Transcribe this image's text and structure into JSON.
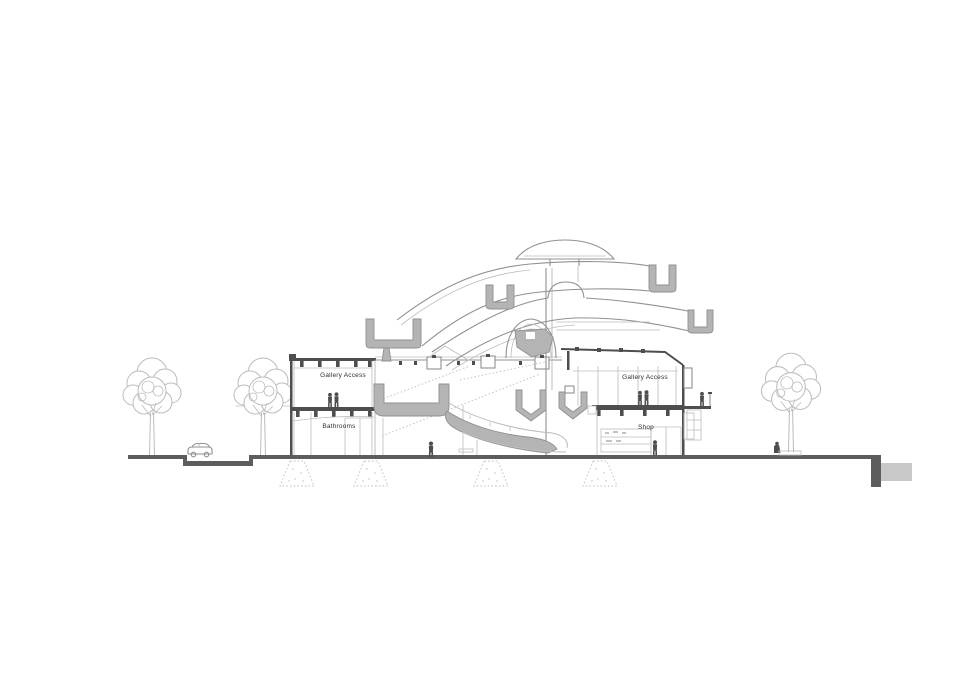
{
  "labels": {
    "left_upper_room": "Gallery Access",
    "left_lower_room": "Bathrooms",
    "right_upper_room": "Gallery Access",
    "right_lower_room": "Shop"
  },
  "colors": {
    "background": "#ffffff",
    "line-light": "#bcbcbc",
    "line-mid": "#909090",
    "line-dark": "#4e4e4e",
    "poche": "#b4b4b4",
    "ground": "#5d5d5d",
    "ground-block": "#c8c8c8",
    "label": "#2f2f2f"
  }
}
